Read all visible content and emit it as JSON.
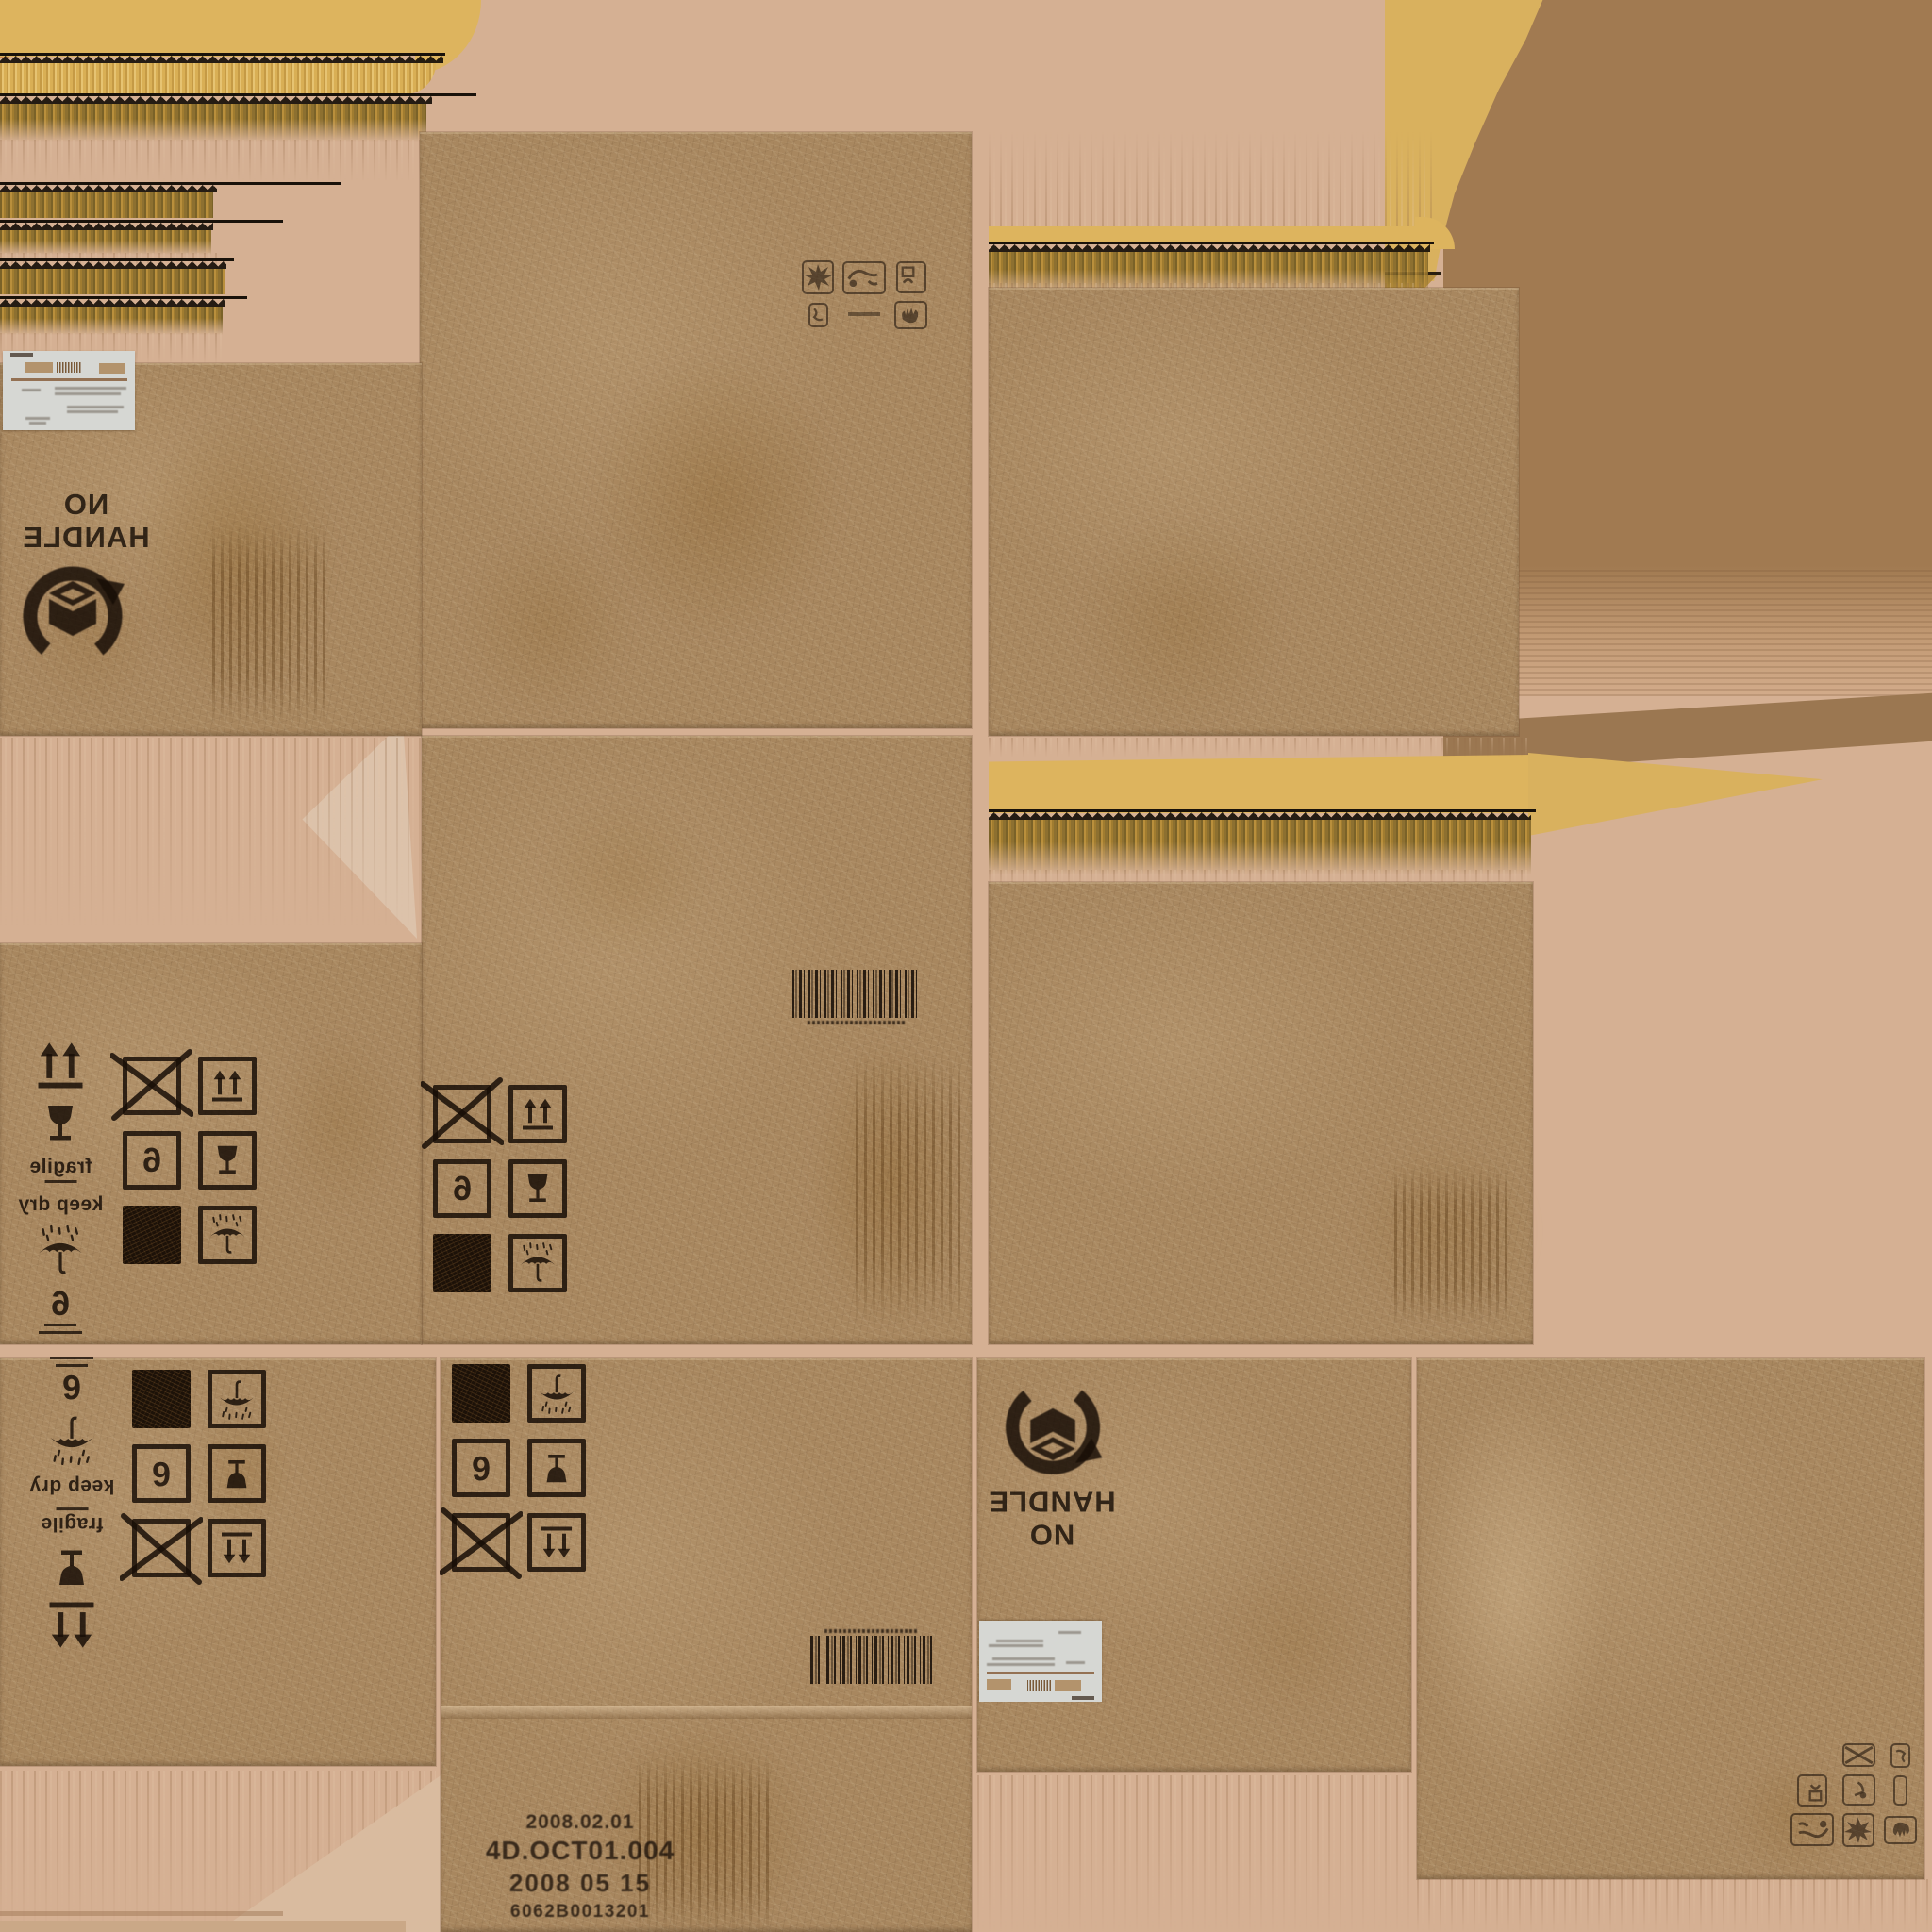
{
  "colors": {
    "background_pink": "#d5b093",
    "background_brown": "#a17a51",
    "cardboard": "#a8875f",
    "corrugation_yellow": "#ddb45e",
    "stamp_ink": "#241a10",
    "label_white": "#d6d7d3",
    "stain_yellow": "#c8a95e"
  },
  "stamps": {
    "no_handle": {
      "line1": "NO",
      "line2": "HANDLE"
    },
    "fragile": "fragile",
    "keep_dry": "keep dry",
    "stack_limit": "6",
    "print_code": {
      "line1": "2008.02.01",
      "line2": "4D.OCT01.004",
      "line3": "2008 05 15",
      "line4": "6062B0013201"
    }
  },
  "symbol_grids": {
    "upper_left": {
      "rows": [
        [
          "no-stacking-crossed-box-icon",
          "this-way-up-box-icon"
        ],
        [
          "stack-limit-6-box-icon",
          "fragile-glass-box-icon"
        ],
        [
          "solid-ink-box-icon",
          "keep-dry-umbrella-box-icon"
        ]
      ]
    },
    "upper_mid": {
      "rows": [
        [
          "no-stacking-crossed-box-icon",
          "this-way-up-box-icon"
        ],
        [
          "stack-limit-6-box-icon",
          "fragile-glass-box-icon"
        ],
        [
          "solid-ink-box-icon",
          "keep-dry-umbrella-box-icon"
        ]
      ]
    },
    "lower_left": {
      "rows": [
        [
          "solid-ink-box-icon",
          "keep-dry-umbrella-box-icon"
        ],
        [
          "stack-limit-6-box-icon",
          "fragile-glass-box-icon"
        ],
        [
          "no-stacking-crossed-box-icon",
          "this-way-up-box-icon"
        ]
      ]
    },
    "lower_mid": {
      "rows": [
        [
          "solid-ink-box-icon",
          "keep-dry-umbrella-box-icon"
        ],
        [
          "stack-limit-6-box-icon",
          "fragile-glass-box-icon"
        ],
        [
          "no-stacking-crossed-box-icon",
          "this-way-up-box-icon"
        ]
      ]
    }
  },
  "icon_columns": {
    "upper": [
      "this-way-up-icon",
      "fragile-glass-icon",
      "fragile-text",
      "keep-dry-text",
      "keep-dry-umbrella-icon",
      "stack-limit-6-icon"
    ],
    "lower": [
      "stack-limit-6-icon",
      "keep-dry-umbrella-icon",
      "keep-dry-text",
      "fragile-text",
      "fragile-glass-icon",
      "this-way-up-icon"
    ]
  },
  "icon_clusters": {
    "top_panel": [
      "impact-warning-icon",
      "cable-plug-icon",
      "warning-box-icon",
      "small-stamp-icon",
      "stamp-underline-mark",
      "no-hand-icon"
    ],
    "bottom_panel": [
      "no-hand-icon",
      "impact-warning-icon",
      "cable-plug-icon",
      "sliver-stamp-icon",
      "warning-figure-icon",
      "warning-box-icon",
      "small-stamp-icon",
      "crossed-small-icon",
      "empty-slot"
    ]
  }
}
